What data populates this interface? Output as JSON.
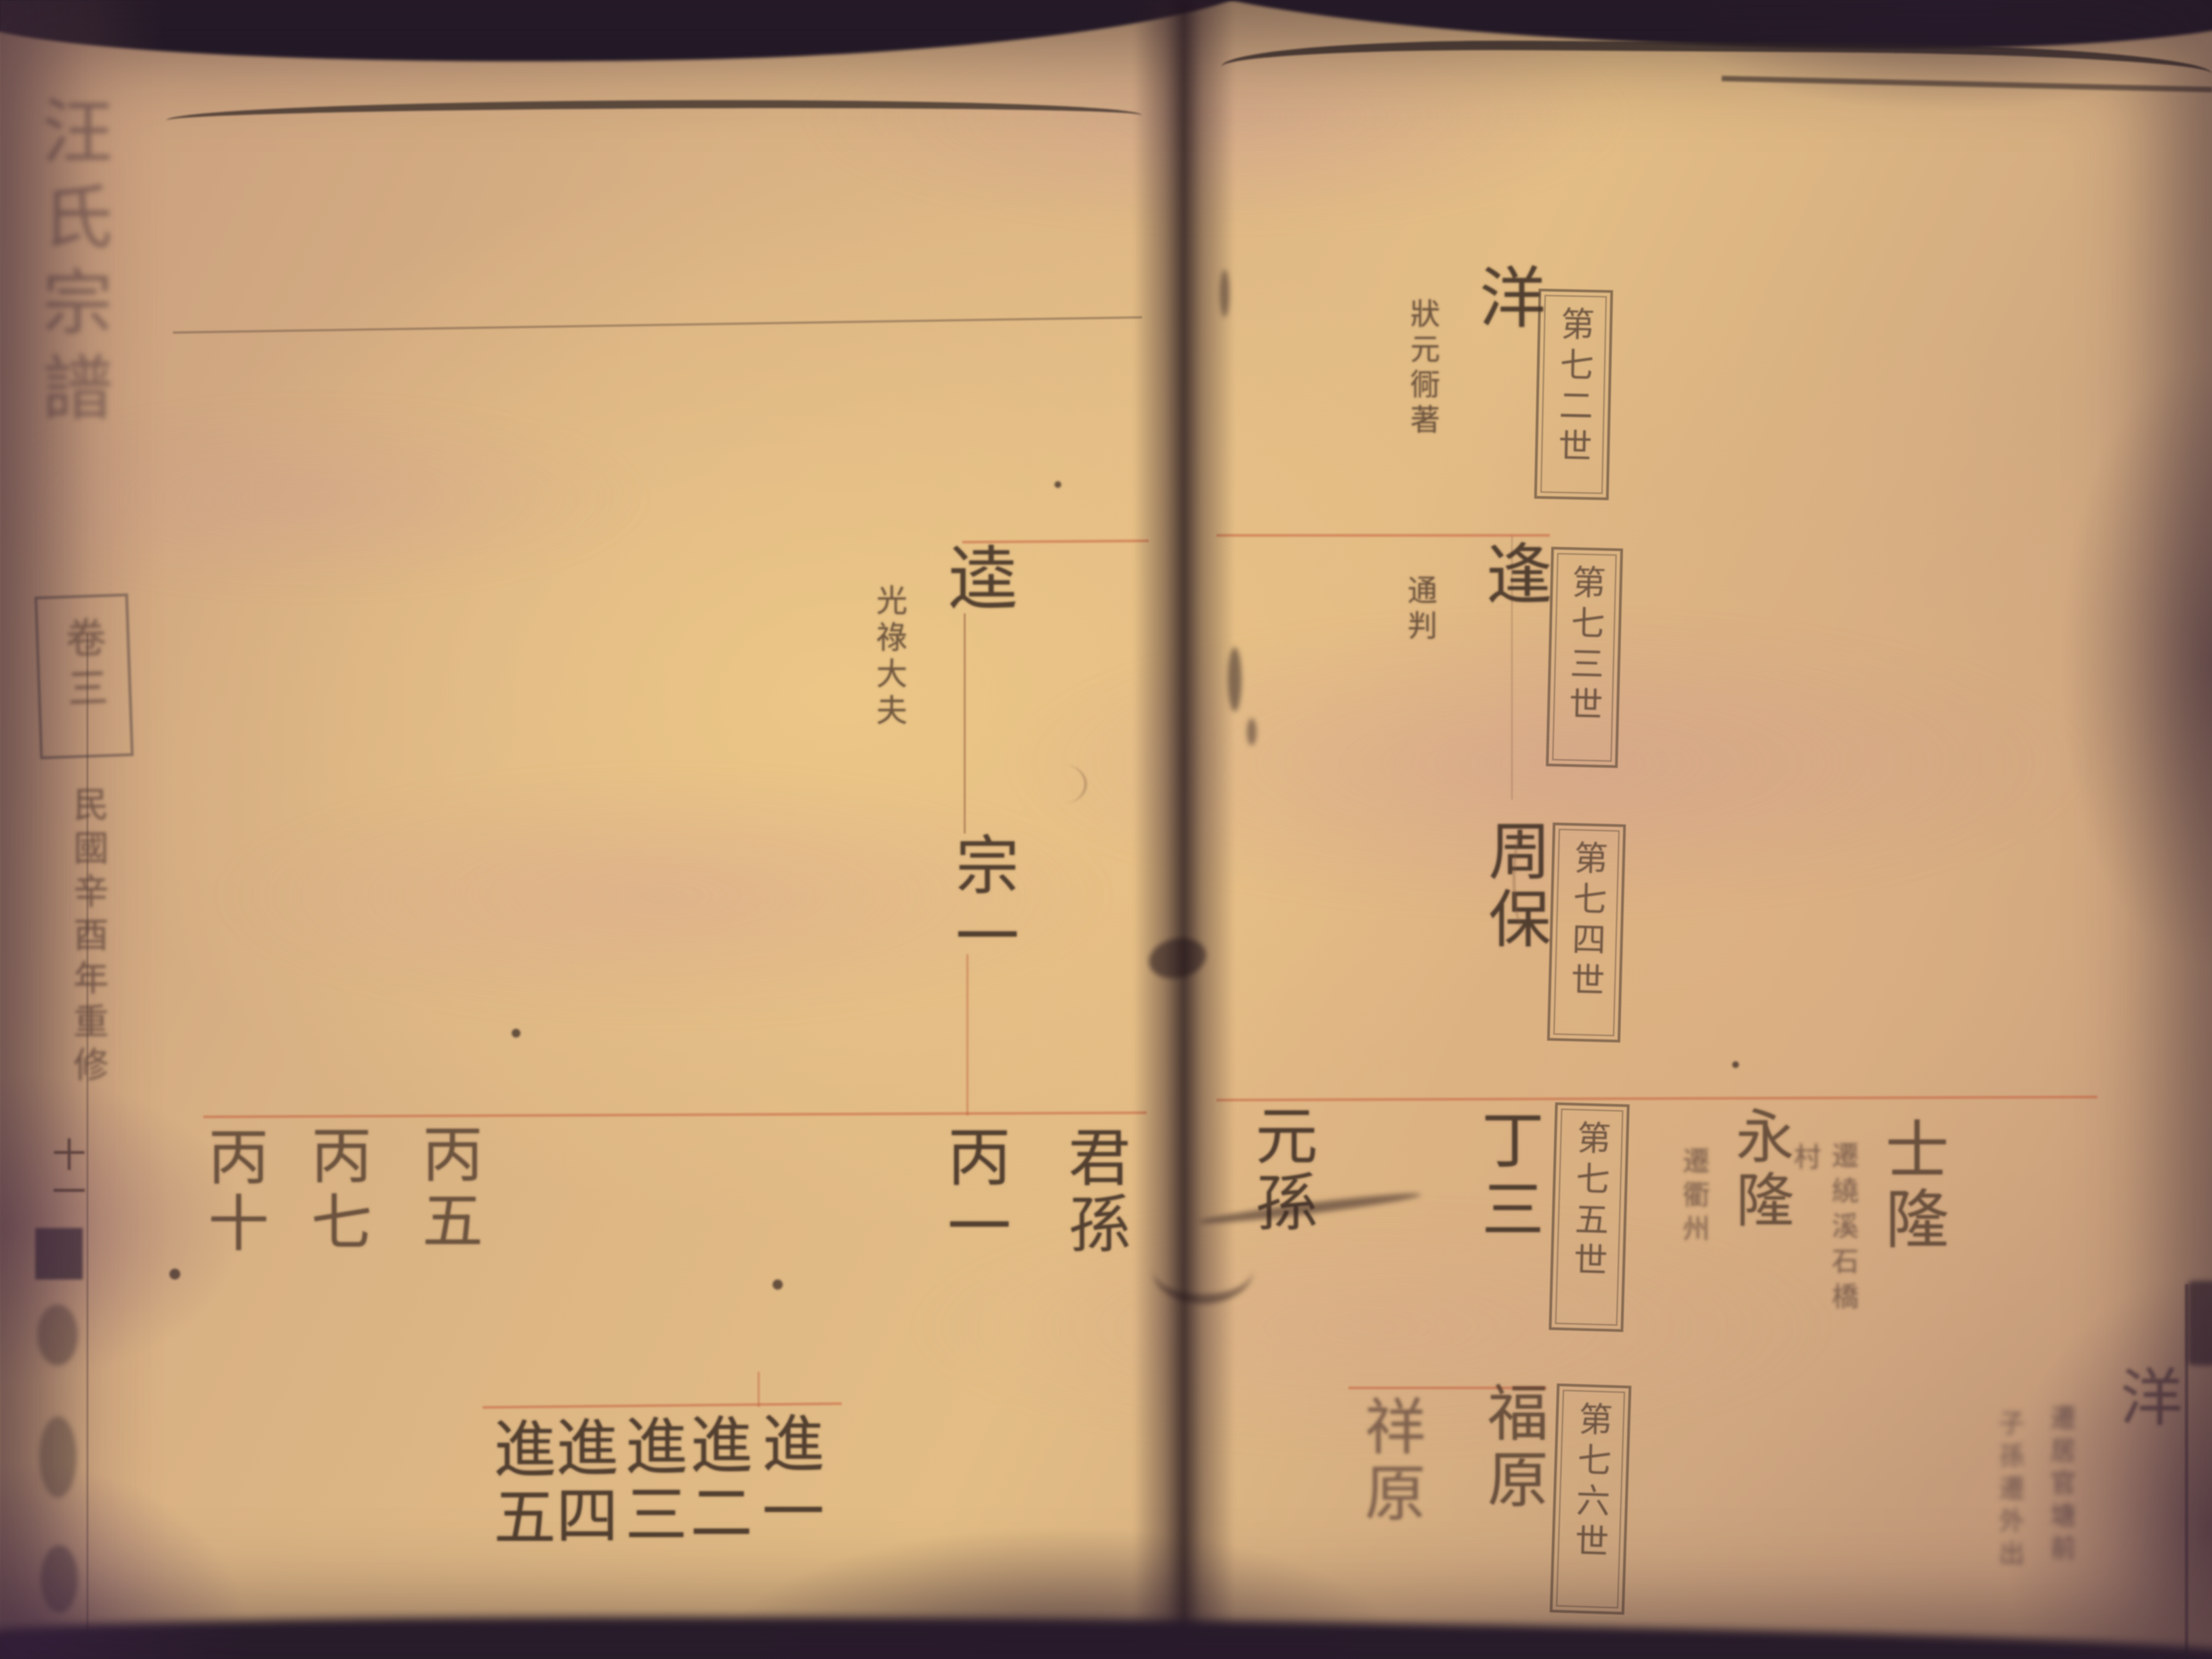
{
  "spine": {
    "book_title": "汪氏宗譜",
    "volume_label": "卷三",
    "edition_note": "民國辛酉年重修",
    "page_number": "十一"
  },
  "left_page": {
    "patriarch": {
      "name": "逵",
      "title": "光祿大夫"
    },
    "heir": {
      "name": "宗一"
    },
    "row_center": {
      "col1": "丙一",
      "col2": "君孫"
    },
    "row_left": {
      "col1": "丙五",
      "col2": "丙七",
      "col3": "丙十"
    },
    "row_bottom": {
      "col1": "進一",
      "col2": "進二",
      "col3": "進三",
      "col4": "進四",
      "col5": "進五"
    }
  },
  "right_page": {
    "generation_boxes": {
      "box1": "第七二世",
      "box2": "第七三世",
      "box3": "第七四世",
      "box4": "第七五世",
      "box5": "第七六世"
    },
    "main_line": {
      "yang": {
        "name": "洋",
        "annotation": "狀元衕著"
      },
      "feng": {
        "name": "逢",
        "annotation": "通判"
      },
      "zhoubao": {
        "name": "周保"
      },
      "dingsan": {
        "name": "丁三"
      },
      "fuyuan": {
        "name": "福原"
      },
      "xiangyuan": {
        "name": "祥原"
      },
      "yuansun": {
        "name": "元孫"
      }
    },
    "right_branch": {
      "yonglong": {
        "name": "永隆",
        "annotation": "遷衢州"
      },
      "shilong": {
        "name": "士隆",
        "annotation1": "遷繞溪石橋",
        "annotation2": "村"
      }
    },
    "bottom_right": {
      "name": "洋",
      "annotation1": "遷居官塘前",
      "annotation2": "子孫遷外出"
    }
  }
}
